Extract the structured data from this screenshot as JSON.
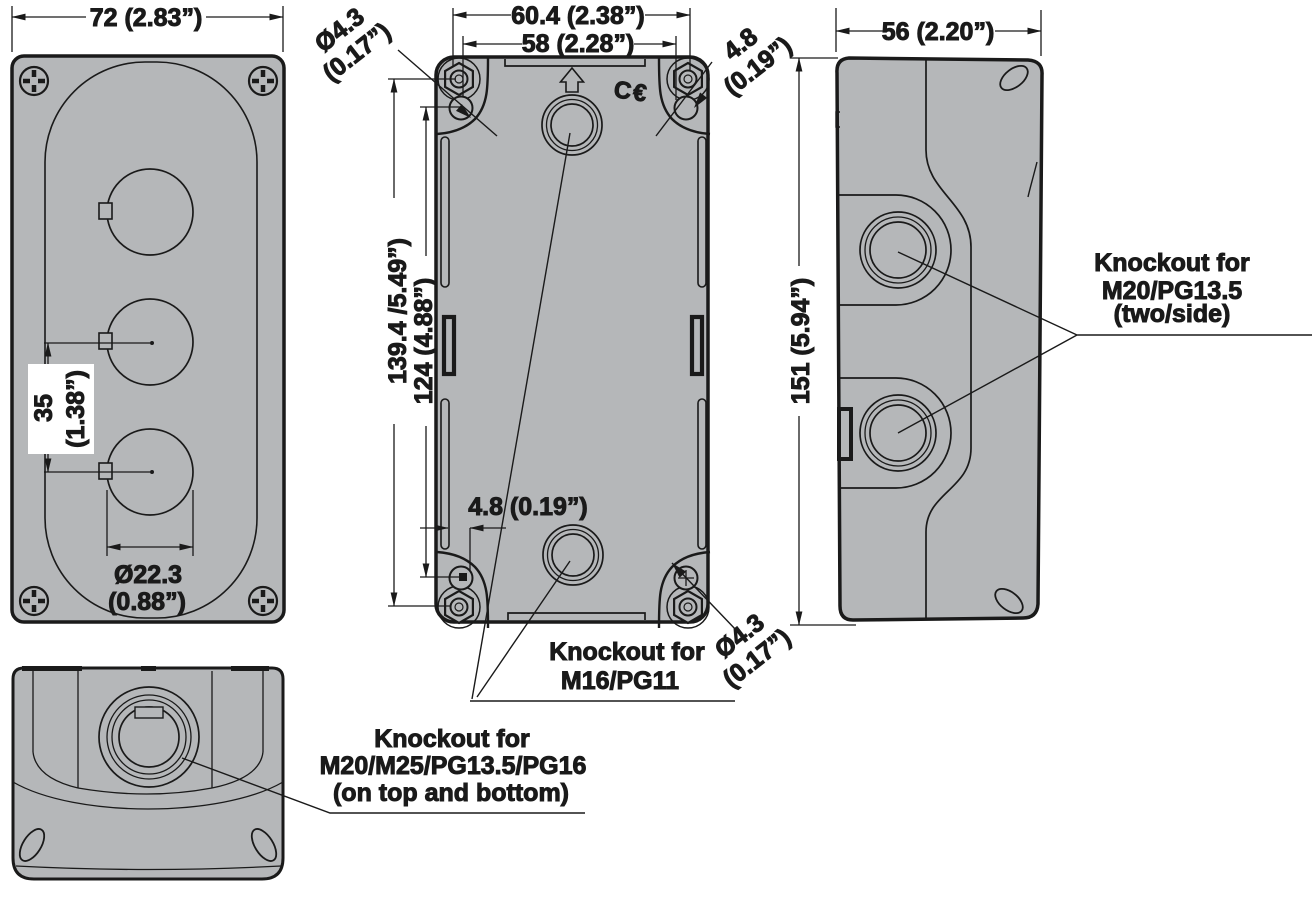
{
  "colors": {
    "body_fill": "#b5b7b9",
    "line": "#1a1a1a",
    "background": "#ffffff"
  },
  "dimensions": {
    "front_width": "72 (2.83”)",
    "button_hole_spacing": "35",
    "button_hole_spacing_in": "(1.38”)",
    "button_hole_diameter": "Ø22.3",
    "button_hole_diameter_in": "(0.88”)",
    "back_slot_width": "60.4 (2.38”)",
    "back_hole_width": "58 (2.28”)",
    "back_slot_height": "139.4 /5.49”)",
    "back_hole_height": "124 (4.88”)",
    "back_hole_offset": "4.8 (0.19”)",
    "mount_hole_dia_upper": "Ø4.3",
    "mount_hole_dia_upper_in": "(0.17”)",
    "mount_slot_offset_upper": "4.8",
    "mount_slot_offset_upper_in": "(0.19”)",
    "mount_hole_dia_lower": "Ø4.3",
    "mount_hole_dia_lower_in": "(0.17”)",
    "side_depth": "56 (2.20”)",
    "side_height": "151 (5.94”)"
  },
  "labels": {
    "ce_mark": "C€",
    "knockout_side_1": "Knockout for",
    "knockout_side_2": "M20/PG13.5",
    "knockout_side_3": "(two/side)",
    "knockout_ends_1": "Knockout for",
    "knockout_ends_2": "M16/PG11",
    "knockout_top_1": "Knockout for",
    "knockout_top_2": "M20/M25/PG13.5/PG16",
    "knockout_top_3": "(on top and bottom)"
  }
}
